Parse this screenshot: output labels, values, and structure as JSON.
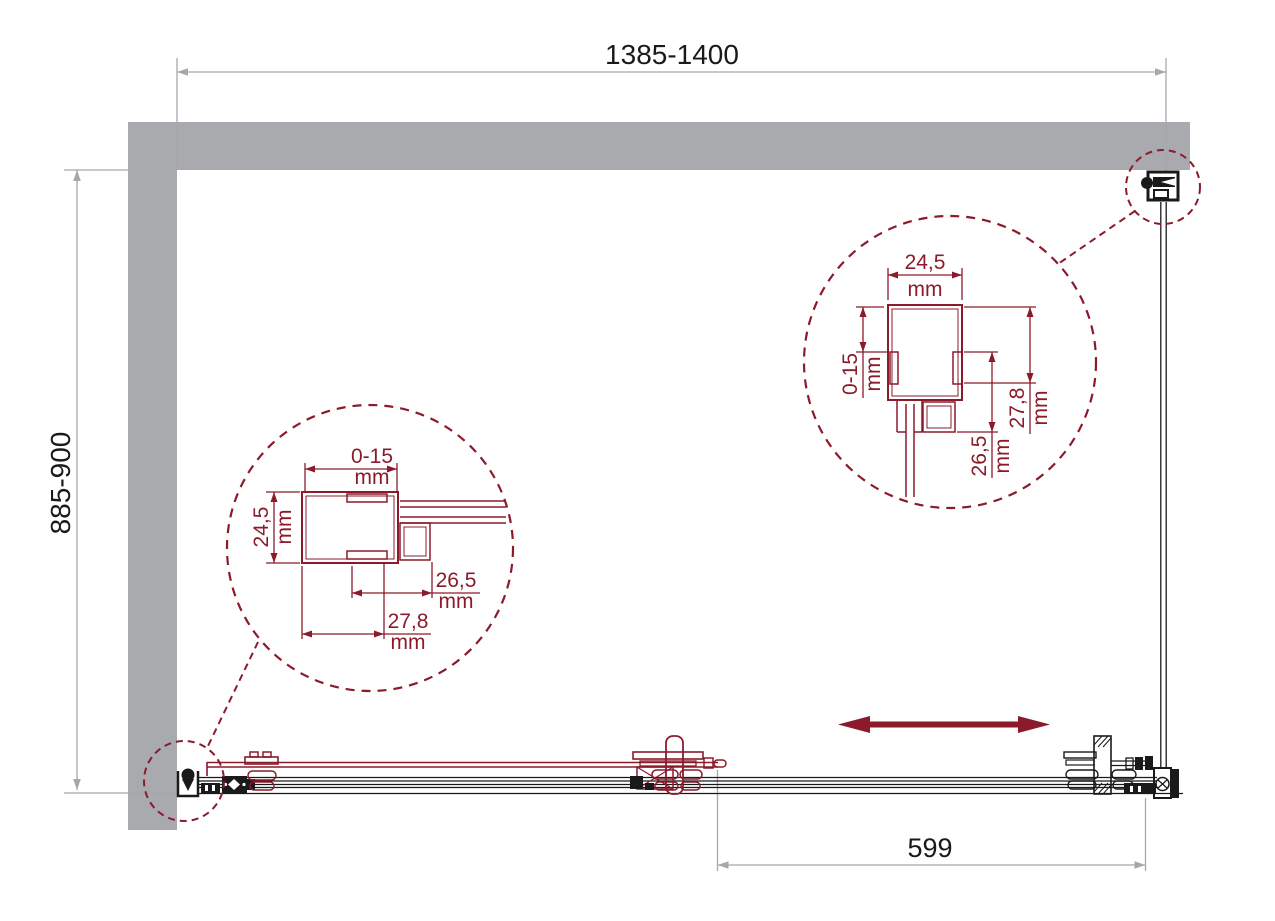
{
  "colors": {
    "accent_maroon": "#8B1B2B",
    "wall_gray": "#A8AAAD",
    "dimension_gray": "#A5A7AA",
    "ink_black": "#1A1A1A"
  },
  "dimensions": {
    "width": {
      "value": "1385-1400"
    },
    "depth": {
      "value": "885-900"
    },
    "door": {
      "value": "599"
    }
  },
  "detail_left": {
    "top": {
      "value": "0-15",
      "unit": "mm"
    },
    "left": {
      "value": "24,5",
      "unit": "mm"
    },
    "right": {
      "value": "26,5",
      "unit": "mm"
    },
    "bottom": {
      "value": "27,8",
      "unit": "mm"
    }
  },
  "detail_right": {
    "top": {
      "value": "24,5",
      "unit": "mm"
    },
    "left": {
      "value": "0-15",
      "unit": "mm"
    },
    "right": {
      "value": "27,8",
      "unit": "mm"
    },
    "bottom": {
      "value": "26,5",
      "unit": "mm"
    }
  }
}
